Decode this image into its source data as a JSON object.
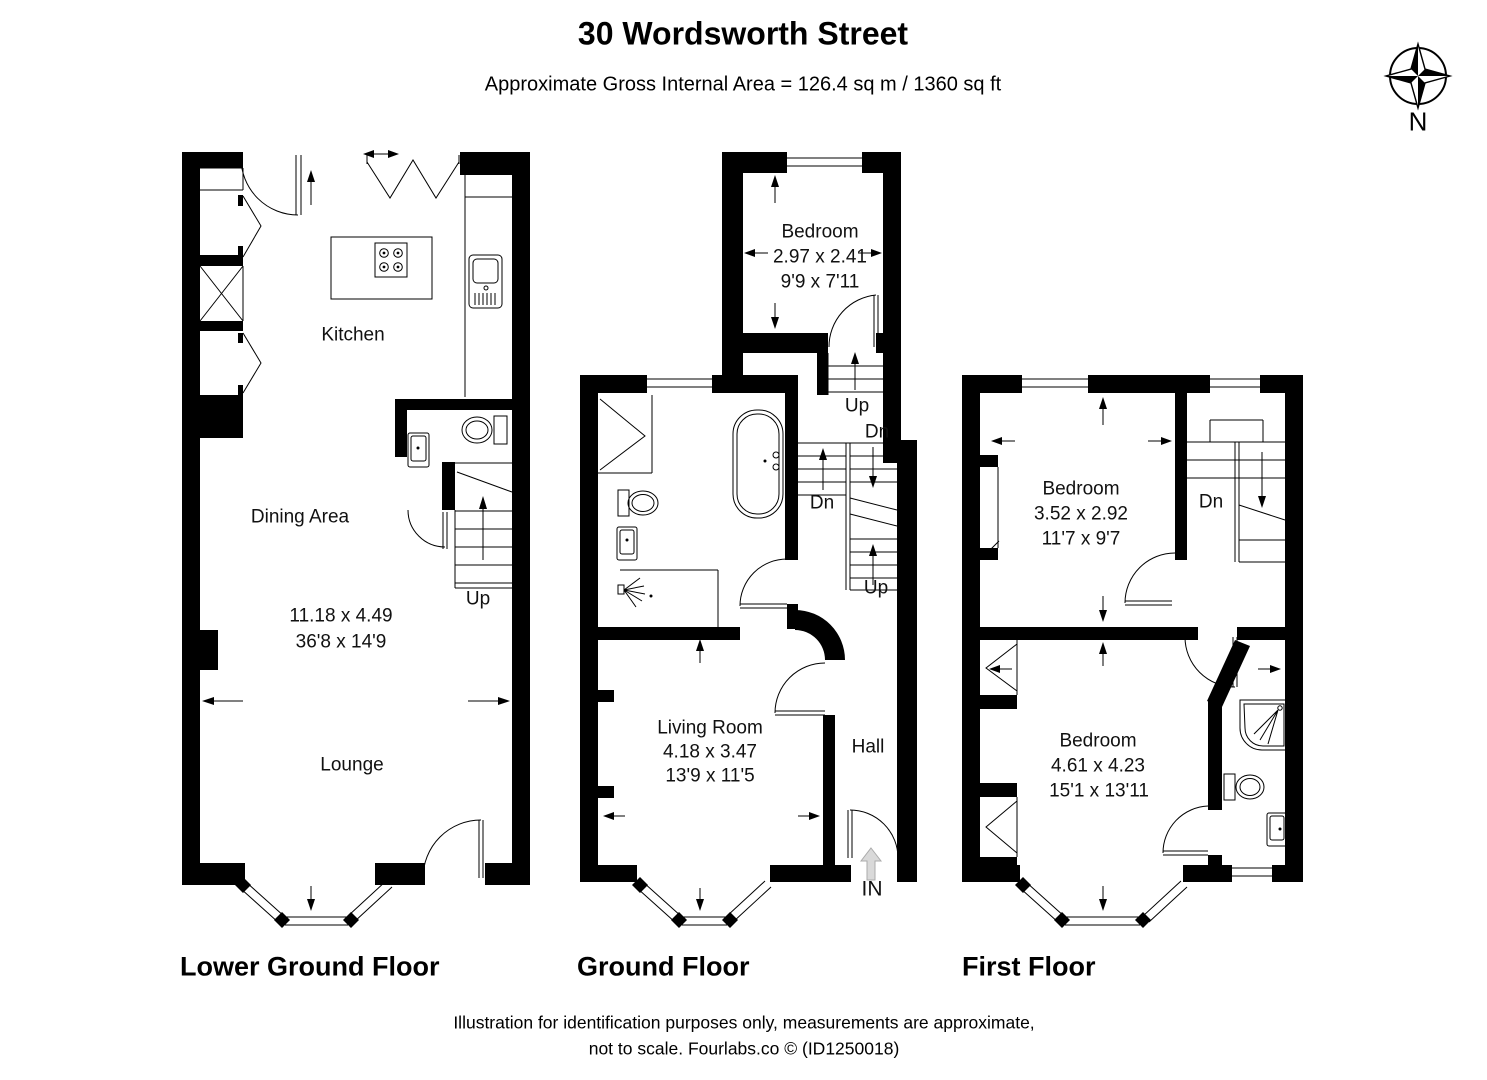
{
  "header": {
    "title": "30 Wordsworth Street",
    "subtitle": "Approximate Gross Internal Area = 126.4 sq m / 1360 sq ft"
  },
  "compass": {
    "north_label": "N"
  },
  "colors": {
    "ink": "#000000",
    "entry_arrow_fill": "#d9d9d9",
    "entry_arrow_stroke": "#ababab"
  },
  "floors": {
    "lower_ground": {
      "title": "Lower Ground Floor",
      "rooms": {
        "kitchen": {
          "name": "Kitchen"
        },
        "dining": {
          "name": "Dining Area",
          "dims_m": "11.18 x 4.49",
          "dims_ft": "36'8 x 14'9"
        },
        "lounge": {
          "name": "Lounge"
        }
      },
      "stairs": {
        "up": "Up"
      }
    },
    "ground": {
      "title": "Ground Floor",
      "rooms": {
        "bedroom": {
          "name": "Bedroom",
          "dims_m": "2.97 x 2.41",
          "dims_ft": "9'9 x 7'11"
        },
        "living": {
          "name": "Living Room",
          "dims_m": "4.18 x 3.47",
          "dims_ft": "13'9 x 11'5"
        },
        "hall": {
          "name": "Hall"
        }
      },
      "stairs": {
        "up1": "Up",
        "dn1": "Dn",
        "dn2": "Dn",
        "up2": "Up"
      },
      "entrance": {
        "label": "IN"
      }
    },
    "first": {
      "title": "First Floor",
      "rooms": {
        "bedroom1": {
          "name": "Bedroom",
          "dims_m": "3.52 x 2.92",
          "dims_ft": "11'7 x 9'7"
        },
        "bedroom2": {
          "name": "Bedroom",
          "dims_m": "4.61 x 4.23",
          "dims_ft": "15'1 x 13'11"
        }
      },
      "stairs": {
        "dn": "Dn"
      }
    }
  },
  "footer": {
    "line1": "Illustration for identification purposes only, measurements are approximate,",
    "line2": "not to scale. Fourlabs.co © (ID1250018)"
  }
}
